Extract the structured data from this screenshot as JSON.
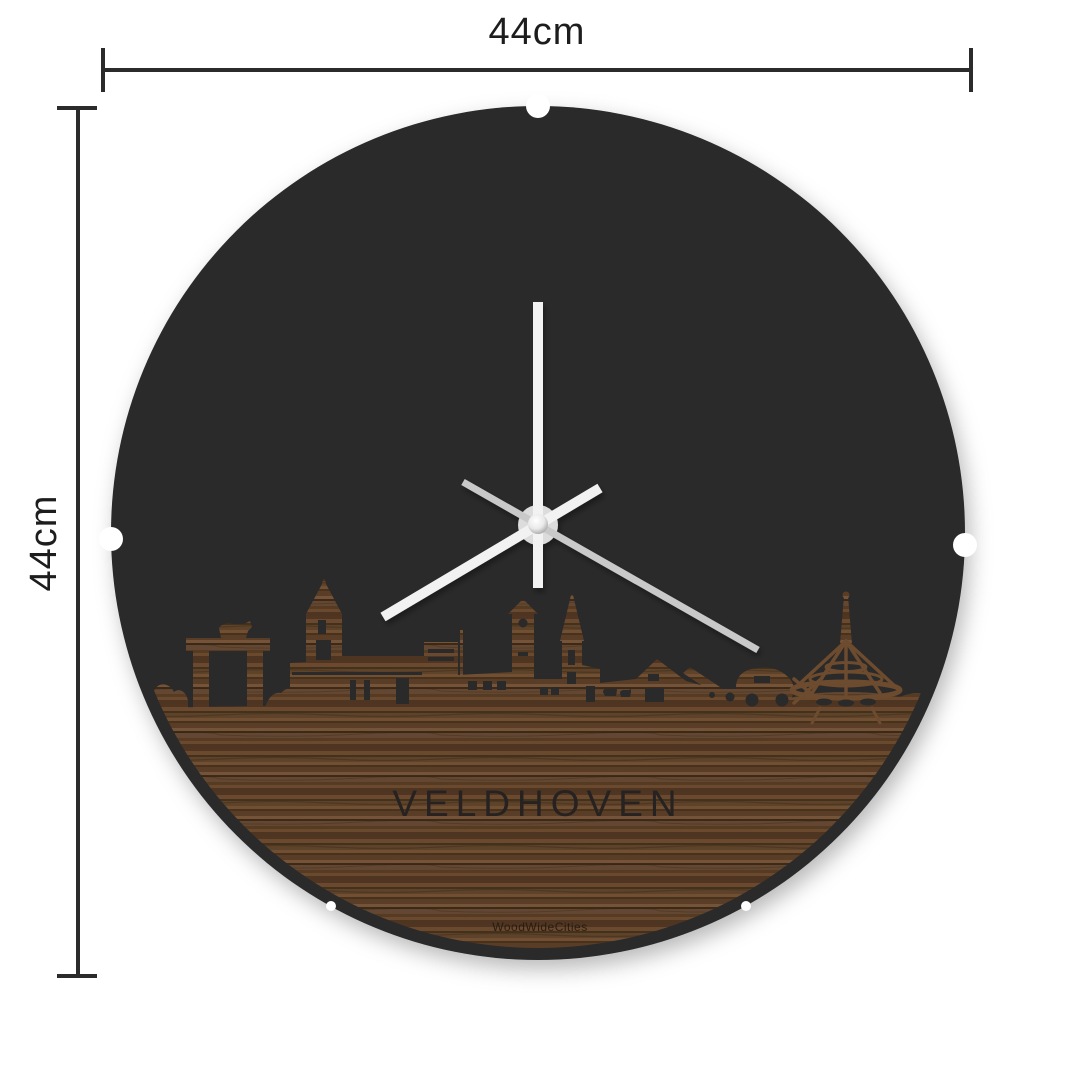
{
  "page": {
    "background": "#ffffff",
    "type": "product-dimension-diagram"
  },
  "dimensions": {
    "width": {
      "label": "44cm"
    },
    "height": {
      "label": "44cm"
    }
  },
  "clock": {
    "city": "VELDHOVEN",
    "brand": "WoodWideCities",
    "hands": {
      "minute_deg": 0,
      "hour_deg": 240,
      "second_deg": 120
    },
    "skyline_features": [
      "bushes",
      "city-gate-arch-with-cow",
      "church-with-spire",
      "flat-roof-block",
      "flag-pole",
      "clock-tower",
      "second-church-spire",
      "farm-barn-with-cows",
      "cannon-with-wheel",
      "vintage-car",
      "lattice-saucer-sculpture"
    ]
  },
  "colors": {
    "disc": "#2a292a",
    "cutout": "#2a292a",
    "wood_base": "#5d4128",
    "hand_primary": "#f2f2f2",
    "hand_second": "#c9c9c9",
    "hub": "#dcdcdc",
    "dimension_line": "#2b2b2b",
    "background": "#ffffff"
  }
}
